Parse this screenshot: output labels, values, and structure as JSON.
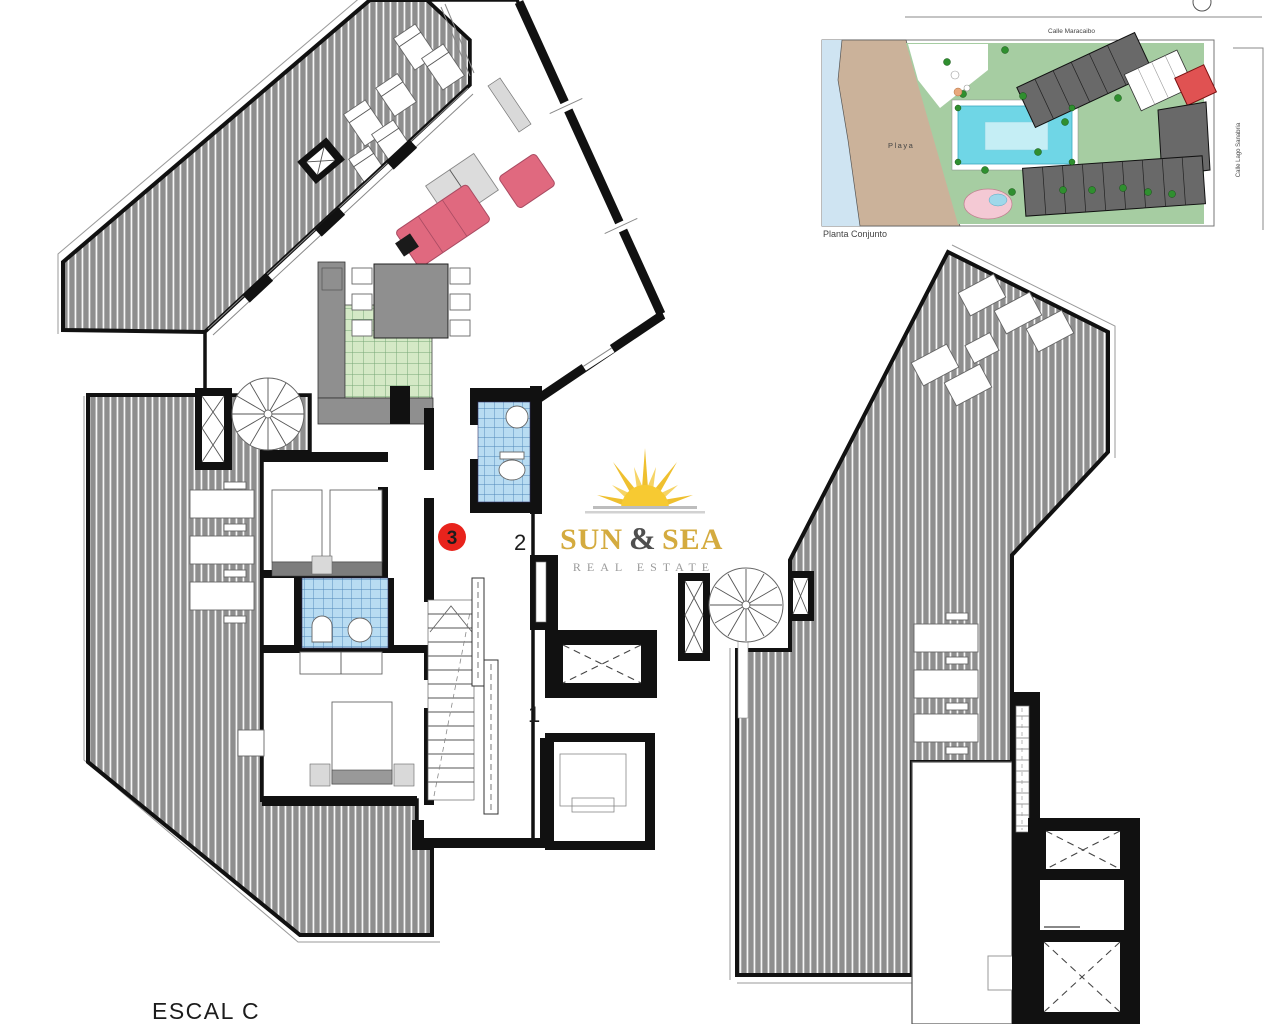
{
  "labels": {
    "unit_badge": "3",
    "zone_2": "2",
    "zone_1": "1",
    "stair_caption": "ESCAL C"
  },
  "logo": {
    "word_sun": "SUN",
    "ampersand": "&",
    "word_sea": "SEA",
    "tagline": "REAL ESTATE"
  },
  "site_plan": {
    "caption": "Planta Conjunto",
    "street_top": "Calle Maracaibo",
    "street_right": "Calle Lago Sanabria",
    "beach_label": "Playa"
  },
  "colors": {
    "terrace": "#8e8e8e",
    "wall": "#111111",
    "bath_tile": "#b8dcf2",
    "bath_grid": "#4e86b8",
    "kitchen_tile": "#d4e9c6",
    "kitchen_grid": "#76a876",
    "sofa": "#e0697f",
    "sofa_edge": "#a94b62",
    "badge": "#e8231c",
    "logo_gold": "#d4ab3f",
    "logo_amp": "#4f4f4f",
    "tagline": "#9a9a9a",
    "furniture_gray": "#8f8f8f",
    "light_gray": "#d9d9d9",
    "site_water": "#cfe4f2",
    "site_sand": "#cbb29a",
    "site_green": "#a6cda2",
    "site_pool": "#6fd6e6",
    "site_building": "#696969",
    "site_red": "#e05252",
    "site_tree": "#2f8f2f"
  }
}
